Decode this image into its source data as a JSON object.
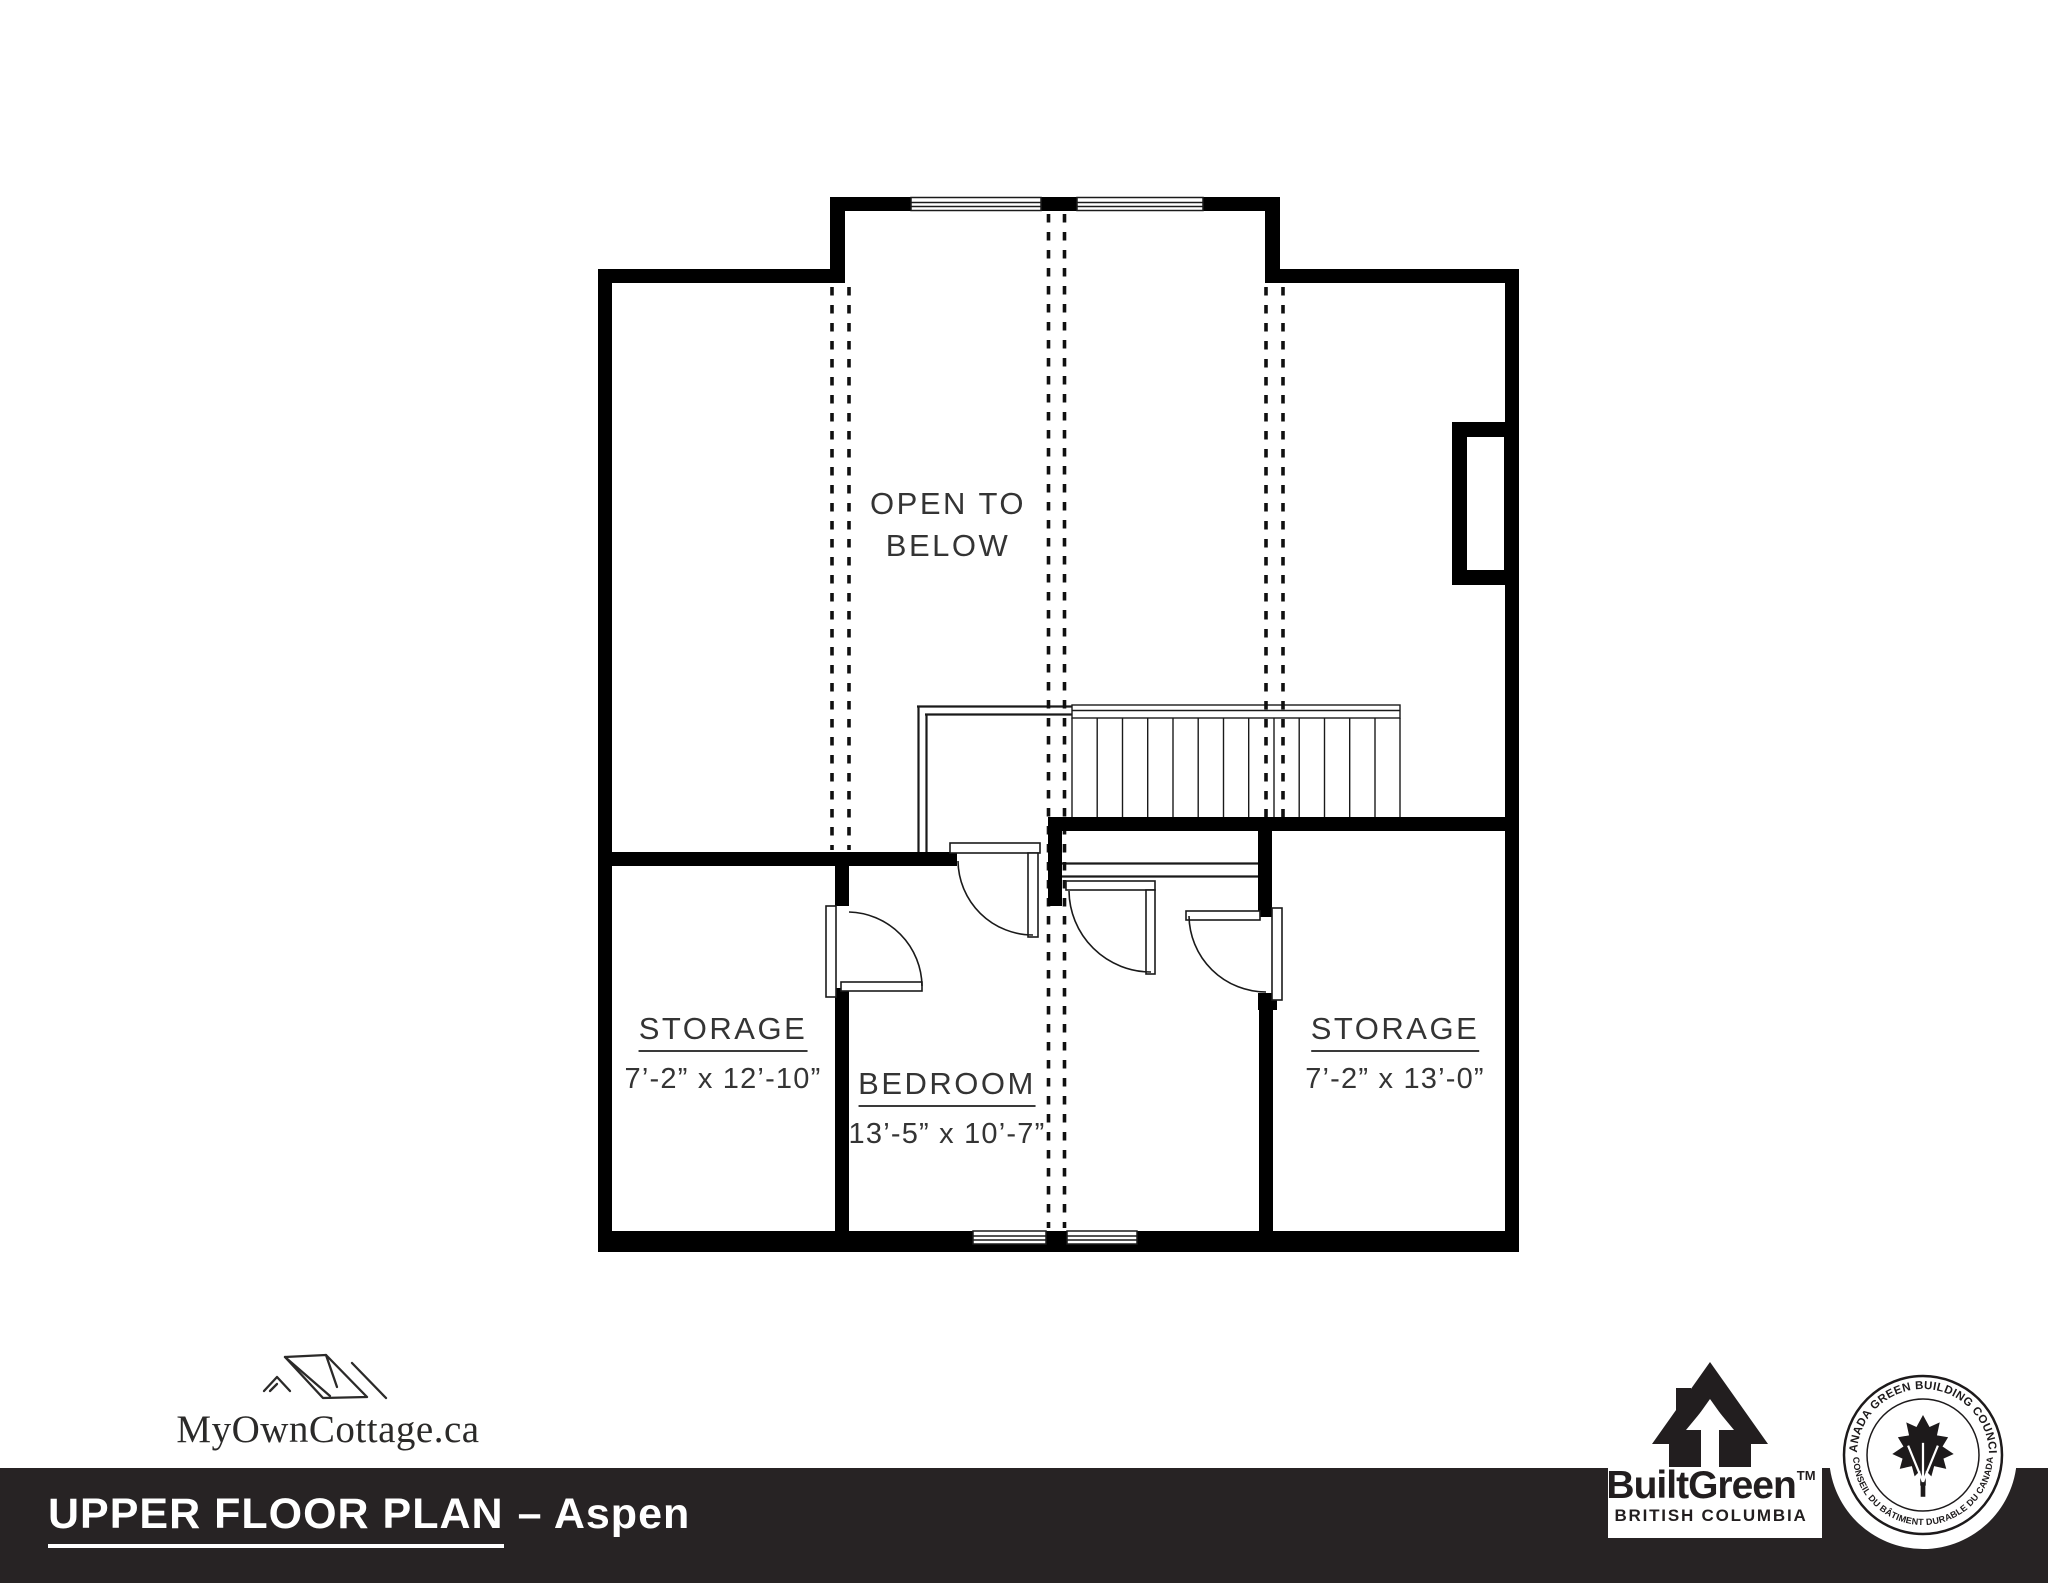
{
  "plan": {
    "open_below_line1": "OPEN TO",
    "open_below_line2": "BELOW",
    "rooms": [
      {
        "name": "STORAGE",
        "dims": "7’-2” x 12’-10”"
      },
      {
        "name": "BEDROOM",
        "dims": "13’-5” x 10’-7”"
      },
      {
        "name": "STORAGE",
        "dims": "7’-2” x 13’-0”"
      }
    ]
  },
  "brand": {
    "name": "MyOwnCottage.ca"
  },
  "footer": {
    "title": "UPPER FLOOR PLAN",
    "suffix": "– Aspen",
    "bar_color": "#272324"
  },
  "builtgreen": {
    "name": "BuiltGreen",
    "tm": "TM",
    "region": "BRITISH COLUMBIA"
  },
  "cgbc": {
    "arc_top": "CANADA GREEN BUILDING COUNCIL",
    "arc_bottom": "• CONSEIL DU BÂTIMENT DURABLE DU CANADA •"
  }
}
